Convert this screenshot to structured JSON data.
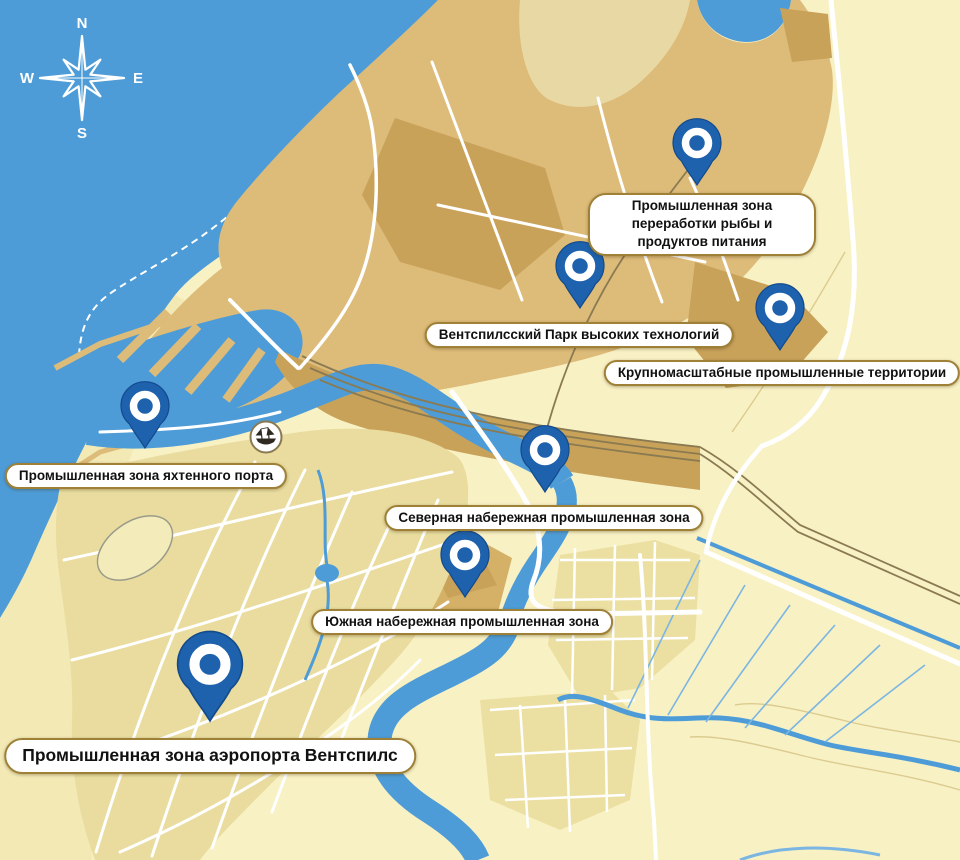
{
  "title": "Карта промышленных зон Вентспилса",
  "compass": {
    "n": "N",
    "e": "E",
    "s": "S",
    "w": "W"
  },
  "icons": {
    "compass": "compass-rose-icon",
    "ship_badge": "sailing-ship-emblem-icon",
    "pin": "location-pin-icon"
  },
  "colors": {
    "sea": "#4E9CD7",
    "land_light": "#F8F1C4",
    "land_dune": "#F2E9B5",
    "land_tan": "#DDBB79",
    "land_dark": "#C9A25A",
    "city_block": "#E9DC9E",
    "pin_blue": "#1E61AC",
    "label_border": "#9E8136",
    "ditch_blue": "#7BB6E2",
    "rail_brown": "#8A7A52"
  },
  "pins": [
    {
      "id": "fish-processing",
      "label": "Промышленная зона переработки рыбы и продуктов питания"
    },
    {
      "id": "high-tech-park",
      "label": "Вентспилсский Парк высоких технологий"
    },
    {
      "id": "large-scale-industry",
      "label": "Крупномасштабные промышленные территории"
    },
    {
      "id": "yacht-port",
      "label": "Промышленная зона яхтенного порта"
    },
    {
      "id": "north-embankment",
      "label": "Северная набережная промышленная зона"
    },
    {
      "id": "south-embankment",
      "label": "Южная набережная промышленная зона"
    },
    {
      "id": "airport",
      "label": "Промышленная зона аэропорта Вентспилс"
    }
  ]
}
